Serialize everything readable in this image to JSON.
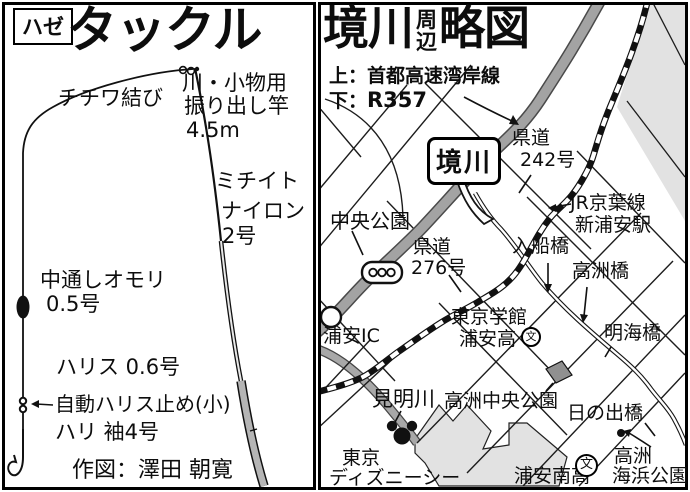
{
  "left_panel": {
    "tag": "ハゼ",
    "title": "タックル",
    "labels": {
      "knot": "チチワ結び",
      "rod_use": "川・小物用",
      "rod_type": "振り出し竿",
      "rod_length": "4.5m",
      "line_name": "ミチイト",
      "line_material": "ナイロン",
      "line_size": "2号",
      "sinker_name": "中通しオモリ",
      "sinker_size": "0.5号",
      "leader": "ハリス 0.6号",
      "stopper": "自動ハリス止め(小)",
      "hook": "ハリ 袖4号",
      "credit": "作図：澤田 朝寛"
    }
  },
  "right_panel": {
    "title_main": "境川",
    "title_sub_top": "周",
    "title_sub_bottom": "辺",
    "title_tail": "略図",
    "legend_top": "上：首都高速湾岸線",
    "legend_bottom_prefix": "下：",
    "legend_bottom_road": "R357",
    "river_callout": "境川",
    "school_mark": "文",
    "labels": {
      "kendo242_l1": "県道",
      "kendo242_l2": "242号",
      "jr_line": "JR京葉線",
      "jr_station": "新浦安駅",
      "chuo_park": "中央公園",
      "kendo276_l1": "県道",
      "kendo276_l2": "276号",
      "irifune_bridge": "入船橋",
      "takasu_bridge": "高洲橋",
      "akemi_bridge": "明海橋",
      "school1_l1": "東京学館",
      "school1_l2": "浦安高",
      "urayasu_ic": "浦安IC",
      "mimei_river": "見明川",
      "takasu_chuo_park": "高洲中央公園",
      "hinode_bridge": "日の出橋",
      "kaihin_l1": "高洲",
      "kaihin_l2": "海浜公園",
      "minami_school": "浦安南高",
      "disney_l1": "東京",
      "disney_l2": "ディズニーシー"
    },
    "colors": {
      "highway_band": "#a3a3a3",
      "area_fill": "#e2e2e2",
      "building_fill": "#909090"
    }
  }
}
